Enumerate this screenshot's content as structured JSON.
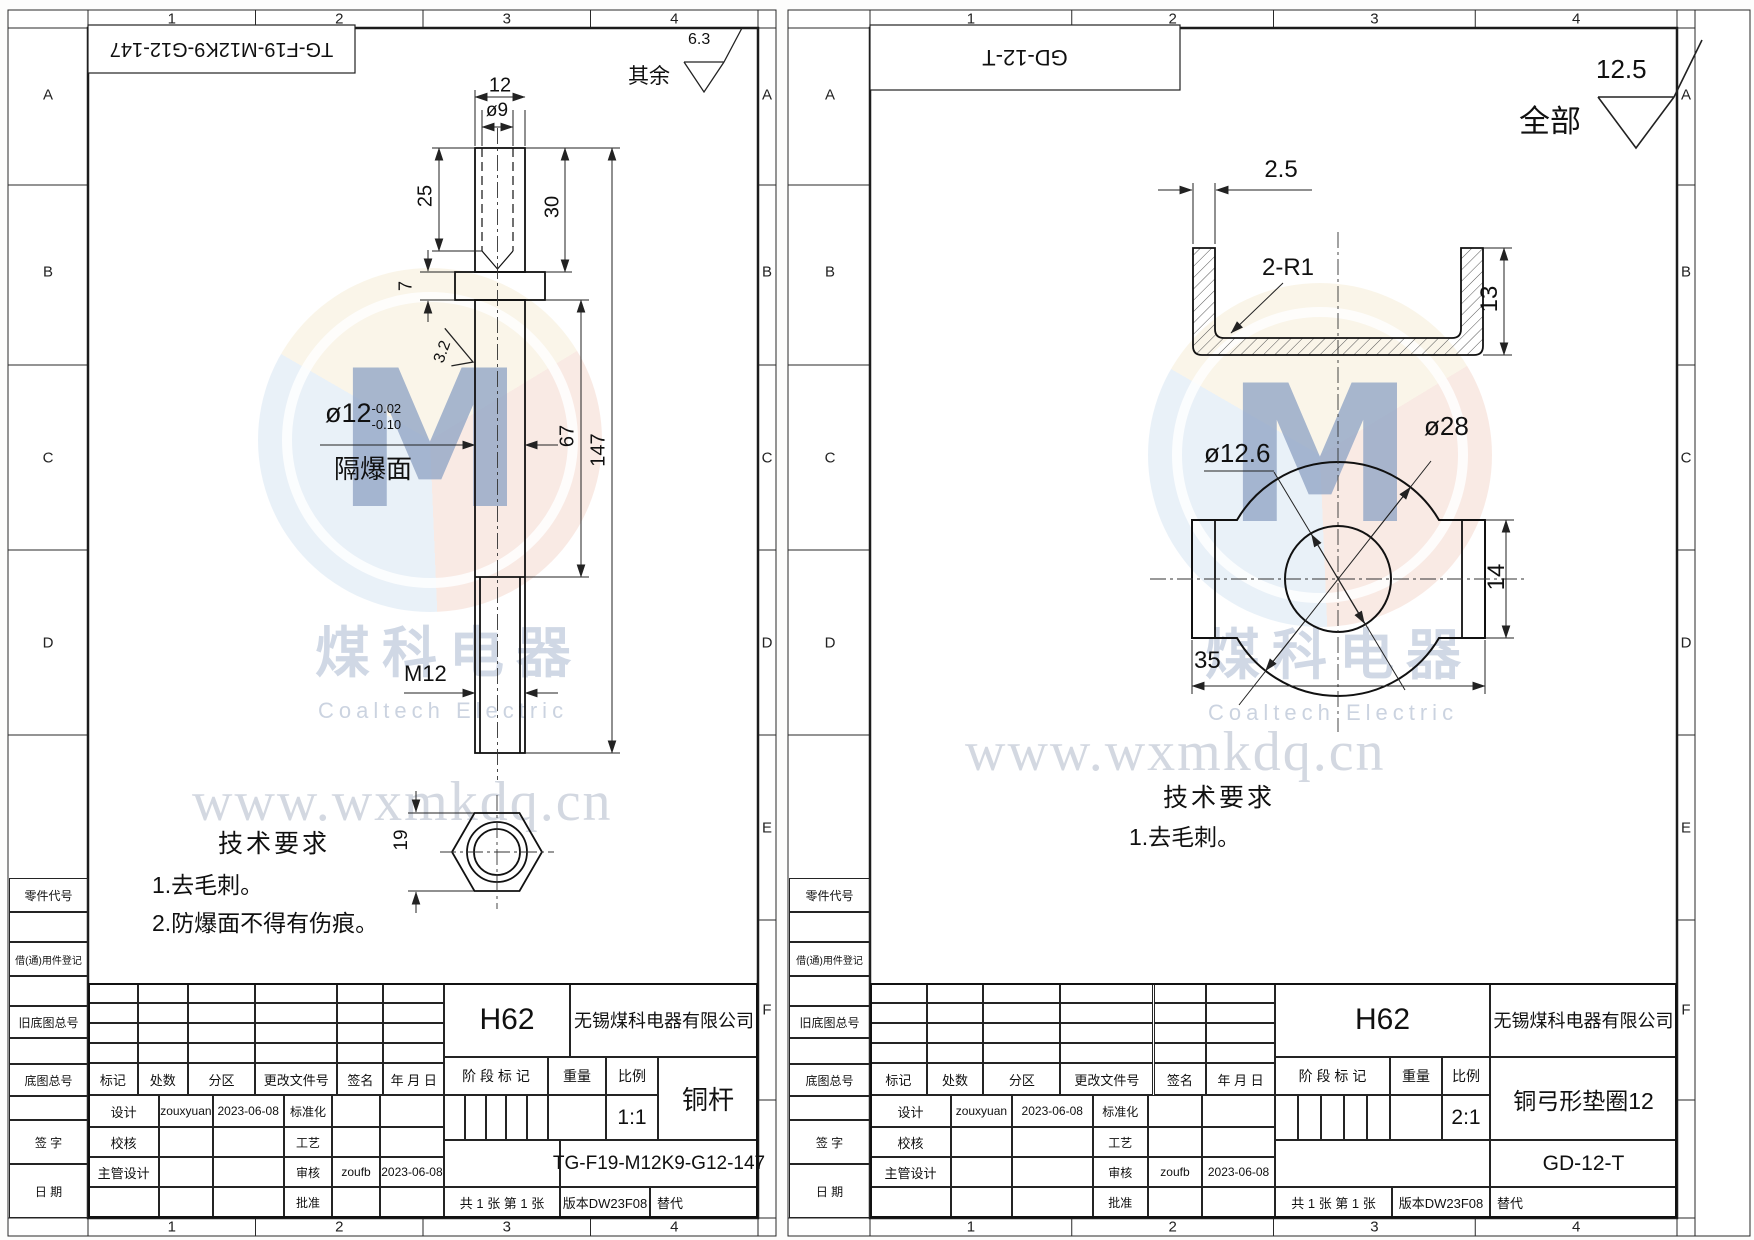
{
  "grid": {
    "cols": [
      "1",
      "2",
      "3",
      "4"
    ],
    "rows": [
      "A",
      "B",
      "C",
      "D",
      "E",
      "F"
    ]
  },
  "margin_labels": [
    "零件代号",
    "借(通)用件登记",
    "旧底图总号",
    "底图总号",
    "签 字",
    "日 期"
  ],
  "watermark": {
    "logo_text": "M",
    "cn": "煤科电器",
    "en": "Coaltech Electric",
    "url": "www.wxmkdq.cn"
  },
  "title_block_labels": {
    "rev_headers": [
      "标记",
      "处数",
      "分区",
      "更改文件号",
      "签名",
      "年 月 日"
    ],
    "sig_rows": [
      [
        "设计",
        "zouxyuan",
        "2023-06-08",
        "标准化",
        "",
        ""
      ],
      [
        "校核",
        "",
        "",
        "工艺",
        "",
        ""
      ],
      [
        "主管设计",
        "",
        "",
        "审核",
        "zoufb",
        "2023-06-08"
      ],
      [
        "",
        "",
        "",
        "批准",
        "",
        ""
      ]
    ],
    "stage": "阶 段 标 记",
    "weight": "重量",
    "scale_label": "比例",
    "sheet_note": "共 1 张  第 1 张",
    "version": "版本DW23F08",
    "replace": "替代"
  },
  "sheets": [
    {
      "part_no_box": "TG-F19-M12K9-G12-147",
      "surface_note": {
        "prefix": "其余",
        "value": "6.3"
      },
      "material": "H62",
      "company": "无锡煤科电器有限公司",
      "part_name": "铜杆",
      "scale": "1:1",
      "drawing_no": "TG-F19-M12K9-G12-147",
      "tech": {
        "title": "技术要求",
        "items": [
          "1.去毛刺。",
          "2.防爆面不得有伤痕。"
        ]
      },
      "dims": {
        "d12": "12",
        "d9": "ø9",
        "d25": "25",
        "d30": "30",
        "d7": "7",
        "d67": "67",
        "d147": "147",
        "tol_main": "ø12",
        "tol_up": "-0.02",
        "tol_dn": "-0.10",
        "flameproof": "隔爆面",
        "r32": "3.2",
        "m12": "M12",
        "d19": "19"
      }
    },
    {
      "part_no_box": "GD-12-T",
      "surface_note": {
        "prefix": "全部",
        "value": "12.5"
      },
      "material": "H62",
      "company": "无锡煤科电器有限公司",
      "part_name": "铜弓形垫圈12",
      "scale": "2:1",
      "drawing_no": "GD-12-T",
      "tech": {
        "title": "技术要求",
        "items": [
          "1.去毛刺。"
        ]
      },
      "dims": {
        "d25": "2.5",
        "r1": "2-R1",
        "d13": "13",
        "d126": "ø12.6",
        "d28": "ø28",
        "d14": "14",
        "d35": "35"
      }
    }
  ]
}
